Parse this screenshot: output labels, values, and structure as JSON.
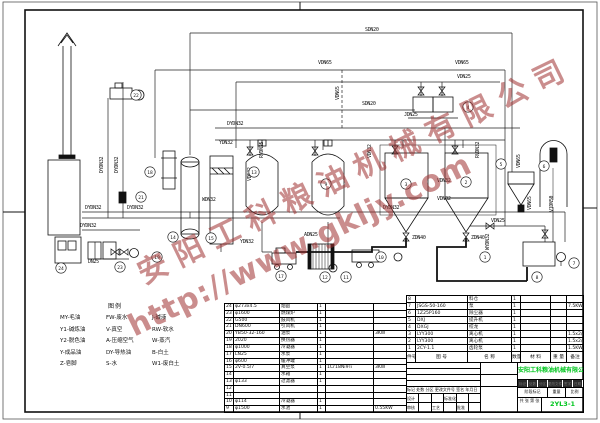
{
  "watermark": {
    "company": "安阳工科粮油机械有限公司",
    "url": "http://www.gkljy.com",
    "color": "#9e3030"
  },
  "legend": {
    "title": "图例",
    "columns": [
      [
        "MY-毛油",
        "Y1-碱炼油",
        "Y2-脱色油",
        "Y-成品油",
        "Z-皂脚"
      ],
      [
        "FW-废水",
        "V-真空",
        "A-压缩空气",
        "DY-导热油",
        "S-水"
      ],
      [
        "J-碱液",
        "RW-软水",
        "W-蒸汽",
        "B-白土",
        "W1-废白土"
      ]
    ]
  },
  "diagram": {
    "pipe_labels": [
      {
        "t": "SDN20",
        "x": 365,
        "y": 31,
        "r": 0
      },
      {
        "t": "VDN65",
        "x": 318,
        "y": 64,
        "r": 0
      },
      {
        "t": "VDN65",
        "x": 455,
        "y": 64,
        "r": 0
      },
      {
        "t": "VDN25",
        "x": 457,
        "y": 78,
        "r": 0
      },
      {
        "t": "VDN65",
        "x": 339,
        "y": 100,
        "r": -90
      },
      {
        "t": "SDN20",
        "x": 362,
        "y": 105,
        "r": 0
      },
      {
        "t": "JDN25",
        "x": 404,
        "y": 116,
        "r": 0
      },
      {
        "t": "DYDN32",
        "x": 227,
        "y": 125,
        "r": 0
      },
      {
        "t": "YDN32",
        "x": 219,
        "y": 144,
        "r": 0
      },
      {
        "t": "RVDN25",
        "x": 263,
        "y": 158,
        "r": -90
      },
      {
        "t": "VDN32",
        "x": 371,
        "y": 158,
        "r": -90
      },
      {
        "t": "RVDN32",
        "x": 479,
        "y": 158,
        "r": -90
      },
      {
        "t": "VDN32",
        "x": 251,
        "y": 181,
        "r": -90
      },
      {
        "t": "WDN32",
        "x": 202,
        "y": 201,
        "r": 0
      },
      {
        "t": "VDN32",
        "x": 437,
        "y": 182,
        "r": 0
      },
      {
        "t": "VDN32",
        "x": 437,
        "y": 200,
        "r": 0
      },
      {
        "t": "DYDN32",
        "x": 103,
        "y": 173,
        "r": -90
      },
      {
        "t": "DYDN32",
        "x": 118,
        "y": 173,
        "r": -90
      },
      {
        "t": "DYDN32",
        "x": 85,
        "y": 209,
        "r": 0
      },
      {
        "t": "DYDN32",
        "x": 127,
        "y": 209,
        "r": 0
      },
      {
        "t": "DYDN32",
        "x": 80,
        "y": 227,
        "r": 0
      },
      {
        "t": "DYDN32",
        "x": 383,
        "y": 209,
        "r": 0
      },
      {
        "t": "YDN32",
        "x": 240,
        "y": 243,
        "r": 0
      },
      {
        "t": "ADN25",
        "x": 304,
        "y": 236,
        "r": 0
      },
      {
        "t": "ZDN40",
        "x": 412,
        "y": 239,
        "r": 0
      },
      {
        "t": "ZDN40",
        "x": 471,
        "y": 239,
        "r": 0
      },
      {
        "t": "WYDN32",
        "x": 489,
        "y": 250,
        "r": -90
      },
      {
        "t": "VDN25",
        "x": 491,
        "y": 222,
        "r": 0
      },
      {
        "t": "VDN65",
        "x": 520,
        "y": 168,
        "r": -90
      },
      {
        "t": "VDN65",
        "x": 531,
        "y": 210,
        "r": -90
      },
      {
        "t": "V1DN50",
        "x": 553,
        "y": 212,
        "r": -90
      },
      {
        "t": "DN25",
        "x": 88,
        "y": 263,
        "r": 0
      }
    ],
    "equipment_tags": [
      {
        "n": "22",
        "x": 136,
        "y": 95
      },
      {
        "n": "18",
        "x": 150,
        "y": 172
      },
      {
        "n": "21",
        "x": 141,
        "y": 197
      },
      {
        "n": "13",
        "x": 254,
        "y": 172
      },
      {
        "n": "9",
        "x": 326,
        "y": 184
      },
      {
        "n": "3",
        "x": 406,
        "y": 184
      },
      {
        "n": "2",
        "x": 466,
        "y": 182
      },
      {
        "n": "4",
        "x": 468,
        "y": 107
      },
      {
        "n": "5",
        "x": 501,
        "y": 164
      },
      {
        "n": "6",
        "x": 544,
        "y": 166
      },
      {
        "n": "14",
        "x": 173,
        "y": 237
      },
      {
        "n": "15",
        "x": 211,
        "y": 238
      },
      {
        "n": "19",
        "x": 157,
        "y": 257
      },
      {
        "n": "23",
        "x": 120,
        "y": 267
      },
      {
        "n": "24",
        "x": 61,
        "y": 268
      },
      {
        "n": "17",
        "x": 281,
        "y": 276
      },
      {
        "n": "12",
        "x": 325,
        "y": 277
      },
      {
        "n": "11",
        "x": 346,
        "y": 277
      },
      {
        "n": "10",
        "x": 381,
        "y": 257
      },
      {
        "n": "1",
        "x": 485,
        "y": 257
      },
      {
        "n": "8",
        "x": 537,
        "y": 277
      },
      {
        "n": "7",
        "x": 574,
        "y": 263
      }
    ]
  },
  "left_table": {
    "rows": [
      [
        "24",
        "φ273x4.5",
        "烟囱",
        "1",
        "",
        ""
      ],
      [
        "23",
        "φ1600",
        "燃煤炉",
        "1",
        "",
        ""
      ],
      [
        "22",
        "G500",
        "鼓风机",
        "1",
        "",
        ""
      ],
      [
        "21",
        "DN600",
        "引风机",
        "1",
        "",
        ""
      ],
      [
        "20",
        "YB50-32-160",
        "油泵",
        "1",
        "",
        "3KW"
      ],
      [
        "19",
        "2020",
        "换热器",
        "1",
        "",
        ""
      ],
      [
        "18",
        "φ1000",
        "冷凝器",
        "1",
        "",
        ""
      ],
      [
        "17",
        "LN25",
        "水泵",
        "1",
        "",
        ""
      ],
      [
        "16",
        "φ600",
        "缓冲罐",
        "1",
        "",
        ""
      ],
      [
        "15",
        "2V-0.5/7",
        "真空泵",
        "1",
        "1Cr18Ni9Ti",
        "3KW"
      ],
      [
        "14",
        "",
        "水箱",
        "1",
        "",
        ""
      ],
      [
        "13",
        "φ133",
        "过滤器",
        "1",
        "",
        ""
      ],
      [
        "12",
        "",
        "",
        "",
        "",
        ""
      ],
      [
        "11",
        "",
        "",
        "",
        "",
        ""
      ],
      [
        "10",
        "φ114",
        "冷凝器",
        "1",
        "",
        ""
      ],
      [
        "9",
        "φ1500",
        "水池",
        "1",
        "",
        "0.55KW"
      ]
    ]
  },
  "right_table": {
    "header": [
      "件号",
      "图 号",
      "名 称",
      "数量",
      "材 料",
      "重 量",
      "备注"
    ],
    "rows": [
      [
        "8",
        "",
        "料仓",
        "1",
        "",
        "",
        ""
      ],
      [
        "7",
        "JSGS-50-160",
        "泵",
        "1",
        "",
        "",
        "7.5KW"
      ],
      [
        "6",
        "1Z25P160",
        "除尘器",
        "1",
        "",
        "",
        ""
      ],
      [
        "5",
        "DXJ",
        "提升机",
        "1",
        "",
        "",
        ""
      ],
      [
        "4",
        "DXGJ",
        "绞龙",
        "1",
        "",
        "",
        ""
      ],
      [
        "3",
        "LYY300",
        "离心机",
        "1",
        "",
        "",
        "1.5x2/4KW"
      ],
      [
        "2",
        "LYY300",
        "离心机",
        "1",
        "",
        "",
        "1.5x2/4KW"
      ],
      [
        "1",
        "2CY-1.1",
        "齿轮泵",
        "1",
        "",
        "",
        "1.5KW"
      ]
    ]
  },
  "title_block": {
    "company": "安阳工科粮油机械有限公司",
    "title": "工艺流程图",
    "drawing_no": "2YL3-1",
    "rev_header": "标记 处数 分区 更改文件号 签名 年月日",
    "sign_row1": [
      "设计",
      "",
      "",
      "标准化",
      "",
      ""
    ],
    "sign_row2": [
      "审核",
      "",
      "工艺",
      "",
      "批准",
      ""
    ],
    "dark_cells": [
      "标记",
      "处数",
      "分区",
      "更改文件号",
      "签字",
      "日期"
    ],
    "stage_cells": [
      "阶段标记",
      "重量",
      "比例"
    ],
    "sheet_note": "共 张 第 张"
  }
}
